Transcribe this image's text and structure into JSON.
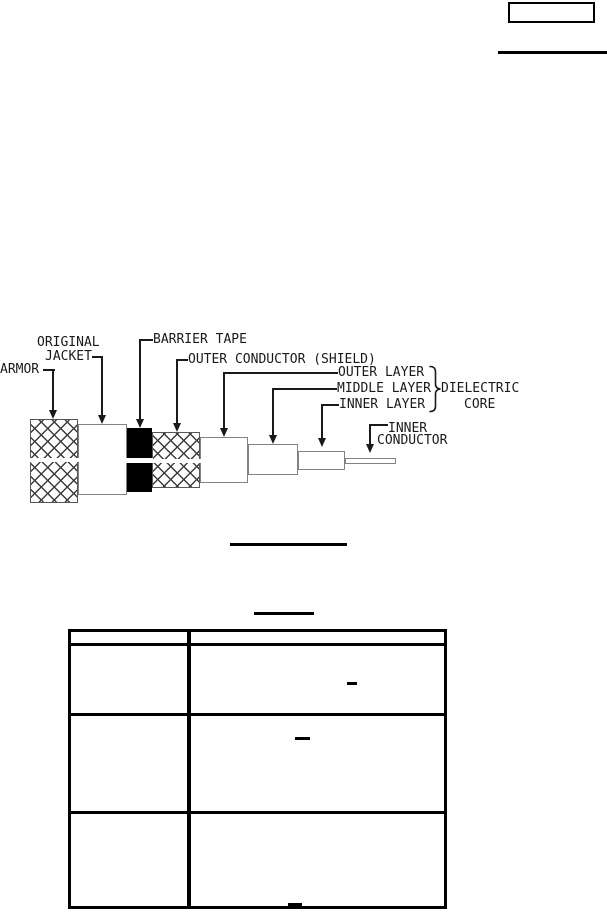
{
  "colors": {
    "ink": "#1a1a1a",
    "table_line": "#000000",
    "hatch_line": "#3c3c3c",
    "cable_outline": "#828282",
    "barrier_fill": "#000000",
    "background": "#ffffff"
  },
  "header": {
    "form_box_text": "",
    "rule_present": true
  },
  "figure": {
    "type": "labeled cutaway diagram of armored coaxial cable",
    "labels": {
      "armor": "ARMOR",
      "original_jacket_line1": "ORIGINAL",
      "original_jacket_line2": "JACKET",
      "barrier_tape": "BARRIER TAPE",
      "outer_conductor": "OUTER CONDUCTOR (SHIELD)",
      "outer_layer": "OUTER LAYER",
      "middle_layer": "MIDDLE LAYER",
      "inner_layer": "INNER LAYER",
      "dielectric_line1": "DIELECTRIC",
      "dielectric_line2": "CORE",
      "inner_conductor_line1": "INNER",
      "inner_conductor_line2": "CONDUCTOR"
    },
    "caption_underline_present": true
  },
  "table": {
    "title_underline_present": true,
    "column_count": 2,
    "body_row_count": 3,
    "visible_cell_marks": [
      "-",
      "-",
      "-"
    ]
  }
}
